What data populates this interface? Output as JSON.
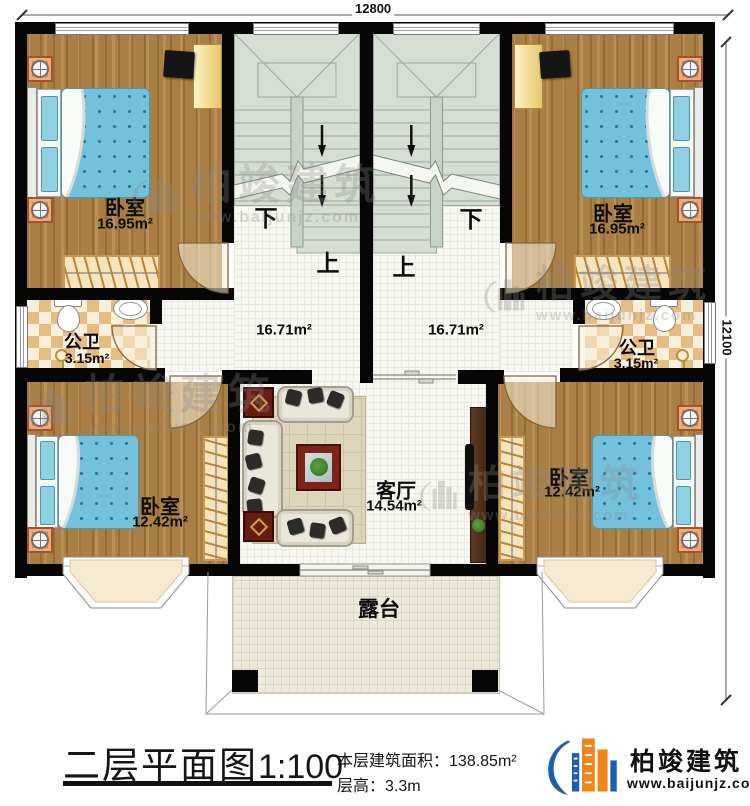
{
  "dimensions": {
    "width": "12800",
    "depth": "12100"
  },
  "rooms": {
    "bedroom_tl": {
      "name": "卧室",
      "area": "16.95m²"
    },
    "bedroom_tr": {
      "name": "卧室",
      "area": "16.95m²"
    },
    "bedroom_bl": {
      "name": "卧室",
      "area": "12.42m²"
    },
    "bedroom_br": {
      "name": "卧室",
      "area": "12.42m²"
    },
    "bath_left": {
      "name": "公卫",
      "area": "3.15m²"
    },
    "bath_right": {
      "name": "公卫",
      "area": "3.15m²"
    },
    "hall_left": {
      "area": "16.71m²"
    },
    "hall_right": {
      "area": "16.71m²"
    },
    "living": {
      "name": "客厅",
      "area": "14.54m²"
    },
    "terrace": {
      "name": "露台"
    }
  },
  "stairs": {
    "up": "上",
    "down": "下"
  },
  "title": {
    "name": "二层平面图",
    "scale": "1:100",
    "floor_area_label": "本层建筑面积：",
    "floor_area": "138.85m²",
    "floor_height_label": "层高：",
    "floor_height": "3.3m"
  },
  "brand": {
    "name": "柏竣建筑",
    "website": "www.baijunjz.com"
  },
  "watermark": {
    "name": "柏竣建筑",
    "url": "www.baijunjz.com"
  },
  "colors": {
    "wall": "#060606",
    "wood": "#aa7f45",
    "bed": "#73c1db",
    "stair": "#d6ddd3",
    "accent_blue": "#1c5fae",
    "accent_orange": "#f08519"
  }
}
